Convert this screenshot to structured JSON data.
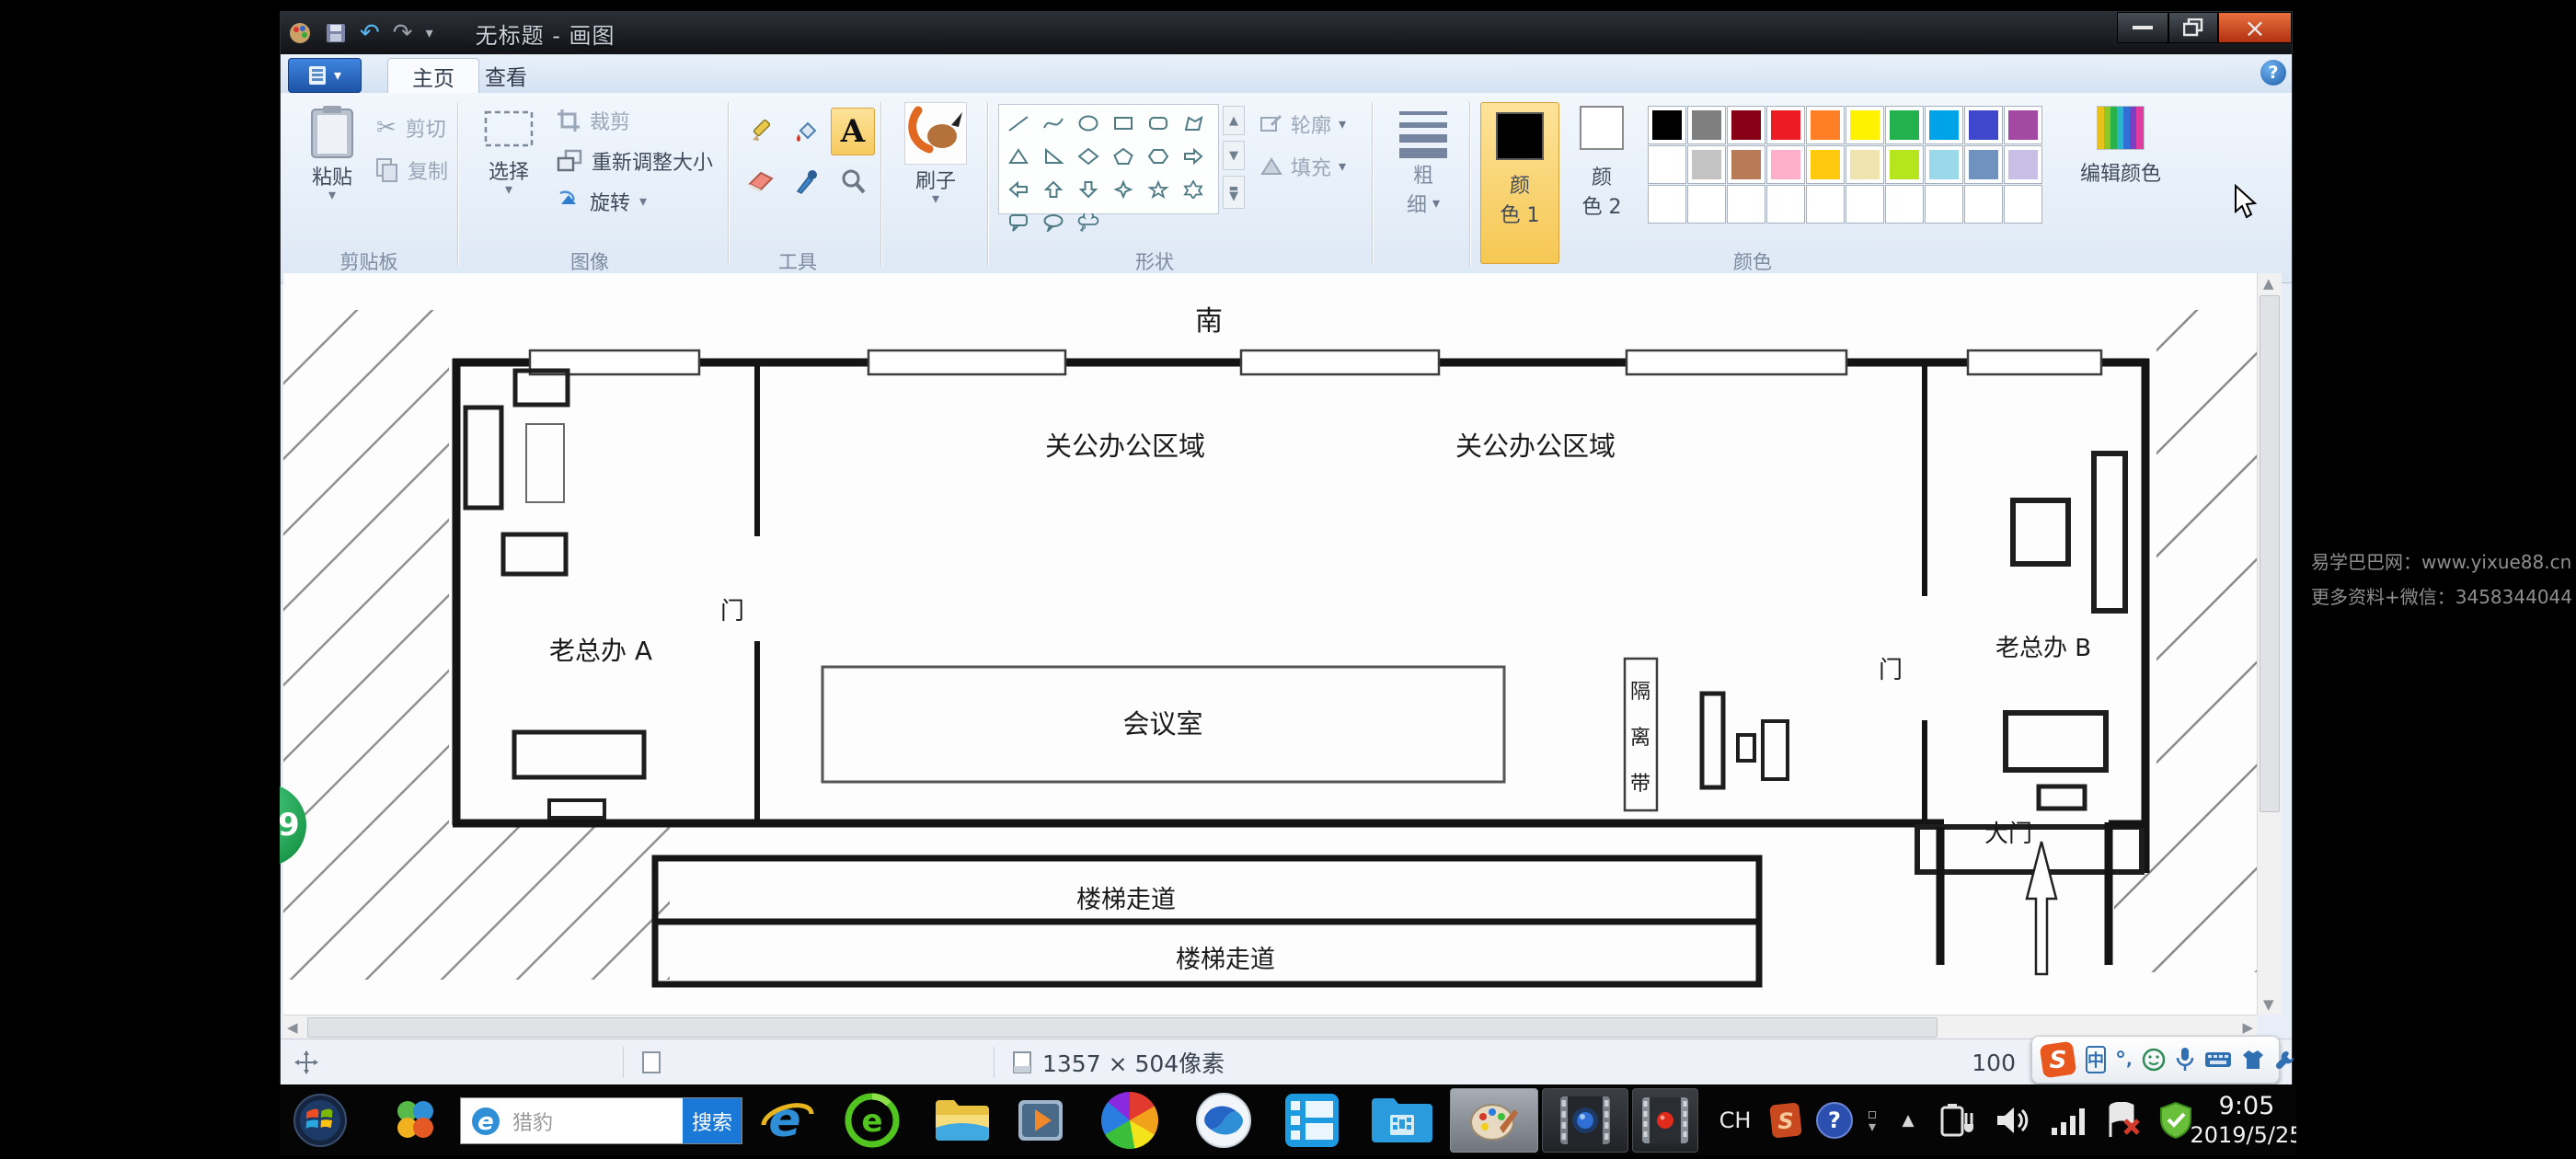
{
  "window": {
    "title": "无标题 - 画图"
  },
  "tabs": {
    "home": "主页",
    "view": "查看"
  },
  "ribbon": {
    "clipboard": {
      "group": "剪贴板",
      "paste": "粘贴",
      "cut": "剪切",
      "copy": "复制"
    },
    "image": {
      "group": "图像",
      "select": "选择",
      "crop": "裁剪",
      "resize": "重新调整大小",
      "rotate": "旋转"
    },
    "tools": {
      "group": "工具"
    },
    "brush": {
      "label": "刷子"
    },
    "shapes": {
      "group": "形状",
      "outline": "轮廓",
      "fill": "填充",
      "items": [
        "line",
        "curve",
        "ellipse",
        "rectangle",
        "rounded-rectangle",
        "polygon",
        "triangle",
        "right-triangle",
        "diamond",
        "pentagon",
        "hexagon",
        "right-arrow",
        "left-arrow",
        "up-arrow",
        "down-arrow",
        "four-point-star",
        "five-point-star",
        "six-point-star",
        "rounded-callout",
        "oval-callout",
        "cloud-callout"
      ]
    },
    "size": {
      "line1": "粗",
      "line2": "细"
    },
    "colors": {
      "group": "颜色",
      "color1_line1": "颜",
      "color1_line2": "色 1",
      "color2_line1": "颜",
      "color2_line2": "色 2",
      "edit": "编辑颜色",
      "color1_value": "#000000",
      "color2_value": "#ffffff",
      "palette_row1": [
        "#000000",
        "#7f7f7f",
        "#880015",
        "#ed1c24",
        "#ff7f27",
        "#fff200",
        "#22b14c",
        "#00a2e8",
        "#3f48cc",
        "#a349a4"
      ],
      "palette_row2": [
        "#ffffff",
        "#c3c3c3",
        "#b97a57",
        "#ffaec9",
        "#ffc90e",
        "#efe4b0",
        "#b5e61d",
        "#99d9ea",
        "#7092be",
        "#c8bfe7"
      ],
      "palette_row3_empty_cells": 10
    }
  },
  "canvas": {
    "floor_plan": {
      "south": "南",
      "office_area_left": "关公办公区域",
      "office_area_right": "关公办公区域",
      "boss_a": "老总办  A",
      "boss_b": "老总办 B",
      "door_a": "门",
      "door_b": "门",
      "meeting_room": "会议室",
      "isolation_chars": [
        "隔",
        "离",
        "带"
      ],
      "main_gate": "大门",
      "stair_corridor_1": "楼梯走道",
      "stair_corridor_2": "楼梯走道"
    }
  },
  "status_bar": {
    "image_size": "1357 × 504像素",
    "zoom": "100"
  },
  "ime_bar": {
    "mode": "中"
  },
  "taskbar": {
    "search_query": "猎豹",
    "search_button": "搜索",
    "tray_language": "CH",
    "time": "9:05",
    "date": "2019/5/25"
  },
  "overlay": {
    "counter": "29",
    "watermark_line1": "易学巴巴网：www.yixue88.cn",
    "watermark_line2": "更多资料+微信：3458344044"
  }
}
